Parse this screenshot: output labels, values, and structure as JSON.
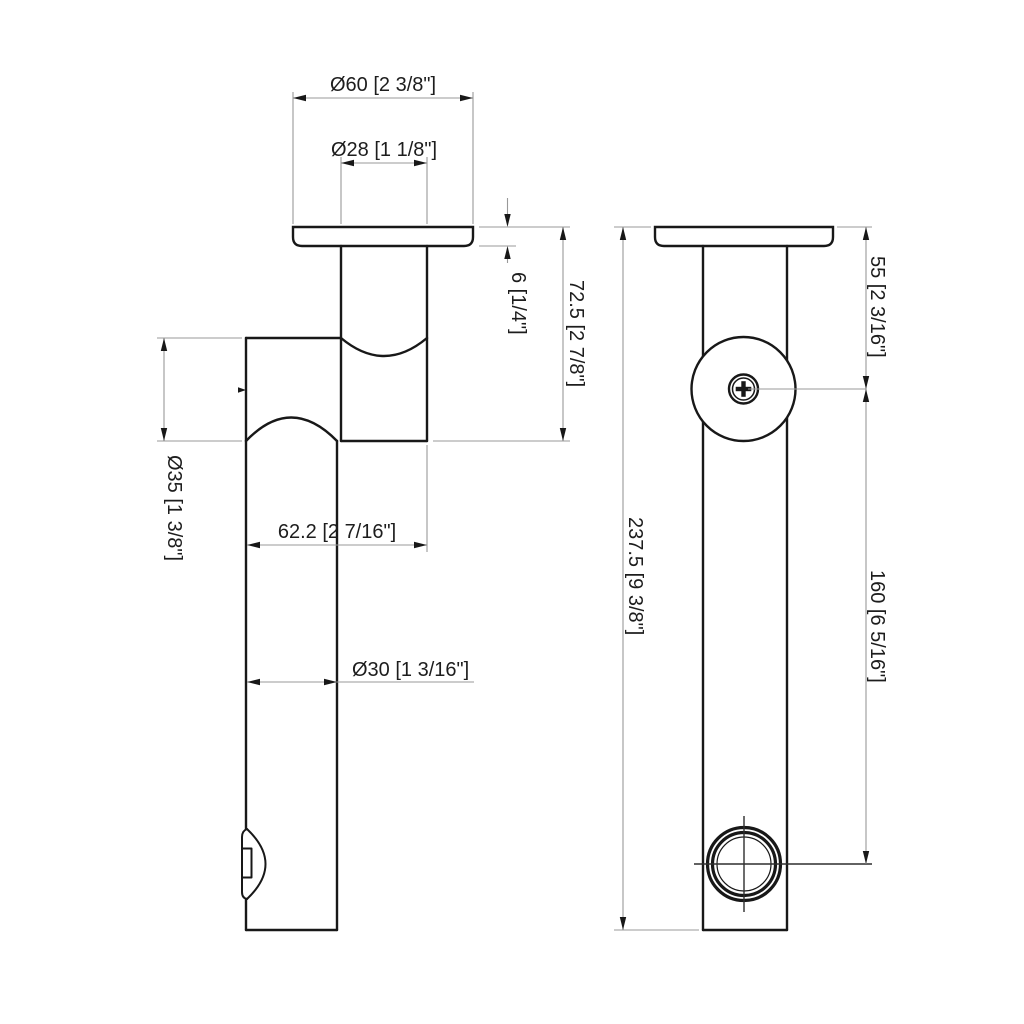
{
  "page": {
    "background_color": "#ffffff",
    "outline_color": "#181818",
    "dimension_line_color": "#999999",
    "text_color": "#1d1d1d"
  },
  "drawing": {
    "kind": "technical dimension drawing, two orthographic views of a ceiling-mount shower arm",
    "units": "millimeters [inches]",
    "dims": {
      "flange_outer": {
        "label": "Ø60 [2 3/8\"]",
        "mm": 60,
        "inches": "2 3/8\""
      },
      "flange_stem": {
        "label": "Ø28 [1 1/8\"]",
        "mm": 28,
        "inches": "1 1/8\""
      },
      "flange_thickness": {
        "label": "6 [1/4\"]",
        "mm": 6,
        "inches": "1/4\""
      },
      "drop_height": {
        "label": "72.5 [2 7/8\"]",
        "mm": 72.5,
        "inches": "2 7/8\""
      },
      "body_diameter": {
        "label": "Ø35 [1 3/8\"]",
        "mm": 35,
        "inches": "1 3/8\""
      },
      "horizontal_offset": {
        "label": "62.2 [2 7/16\"]",
        "mm": 62.2,
        "inches": "2 7/16\""
      },
      "tube_diameter": {
        "label": "Ø30 [1 3/16\"]",
        "mm": 30,
        "inches": "1 3/16\""
      },
      "flange_to_pivot": {
        "label": "55 [2 3/16\"]",
        "mm": 55,
        "inches": "2 3/16\""
      },
      "overall_length": {
        "label": "237.5 [9 3/8\"]",
        "mm": 237.5,
        "inches": "9 3/8\""
      },
      "pivot_to_outlet": {
        "label": "160 [6 5/16\"]",
        "mm": 160,
        "inches": "6 5/16\""
      }
    }
  }
}
